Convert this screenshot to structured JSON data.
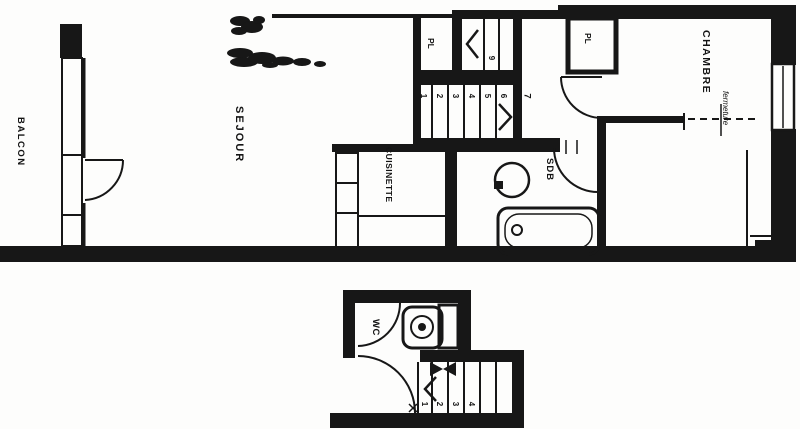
{
  "plan": {
    "colors": {
      "ink": "#171717",
      "paper": "#fdfdfc"
    },
    "rooms": {
      "balcon": {
        "label": "BALCON"
      },
      "sejour": {
        "label": "SEJOUR"
      },
      "cuisinette": {
        "label": "CUISINETTE"
      },
      "sdb": {
        "label": "SDB"
      },
      "chambre": {
        "label": "CHAMBRE"
      },
      "wc": {
        "label": "WC"
      },
      "closet_upper_left": {
        "label": "PL"
      },
      "closet_upper_right": {
        "label": "PL"
      }
    },
    "annotations": {
      "fermeture": "fermeture"
    },
    "stairs": {
      "upper_flight": {
        "treads": [
          "1",
          "2",
          "3",
          "4",
          "5",
          "6"
        ],
        "landing": "7",
        "turn_treads": [
          "9"
        ]
      },
      "lower_flight": {
        "treads": [
          "1",
          "2",
          "3",
          "4"
        ]
      }
    }
  }
}
